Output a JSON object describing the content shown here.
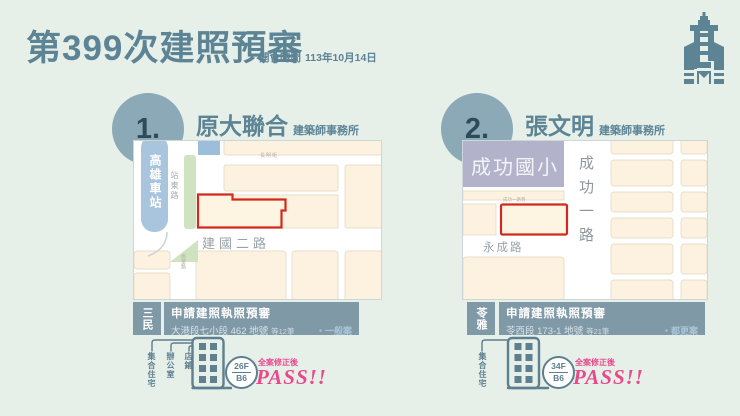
{
  "header": {
    "title": "第399次建照預審",
    "meeting_label": "開會時間",
    "meeting_date": "113年10月14日"
  },
  "colors": {
    "accent_slate": "#5d8495",
    "bar_slate": "#7f99a6",
    "parcel_red": "#d3291c",
    "pass_pink": "#e8498b",
    "station_blue": "#a9c4dd",
    "school_purple": "#b2b2cb",
    "block_cream": "#fcf2df",
    "park_green": "#cfe3c1"
  },
  "case1": {
    "number": "1.",
    "firm": "原大聯合",
    "firm_suffix": "建築師事務所",
    "district": "三民",
    "permit_title": "申請建照執照預審",
    "address": "大港段七小段 462 地號",
    "parcel_count": "等12筆",
    "tag": "・一般案",
    "use1": "集合住宅",
    "use2": "辦公室",
    "use3": "店鋪",
    "floors": "26F",
    "basement": "B6",
    "note": "全案修正後",
    "result": "PASS!!",
    "map": {
      "station": "高雄車站",
      "road_top": "長明街",
      "road_side": "站東路",
      "road_main": "建國二路",
      "road_small": "南華路"
    }
  },
  "case2": {
    "number": "2.",
    "firm": "張文明",
    "firm_suffix": "建築師事務所",
    "district": "苓雅",
    "permit_title": "申請建照執照預審",
    "address": "苓西段 173-1 地號",
    "parcel_count": "等21筆",
    "tag": "・都更案",
    "use1": "集合住宅",
    "floors": "34F",
    "basement": "B6",
    "note": "全案修正後",
    "result": "PASS!!",
    "map": {
      "school": "成功國小",
      "road_main": "成功一路",
      "road_bottom": "永成路",
      "lane": "成功一路巷"
    }
  }
}
